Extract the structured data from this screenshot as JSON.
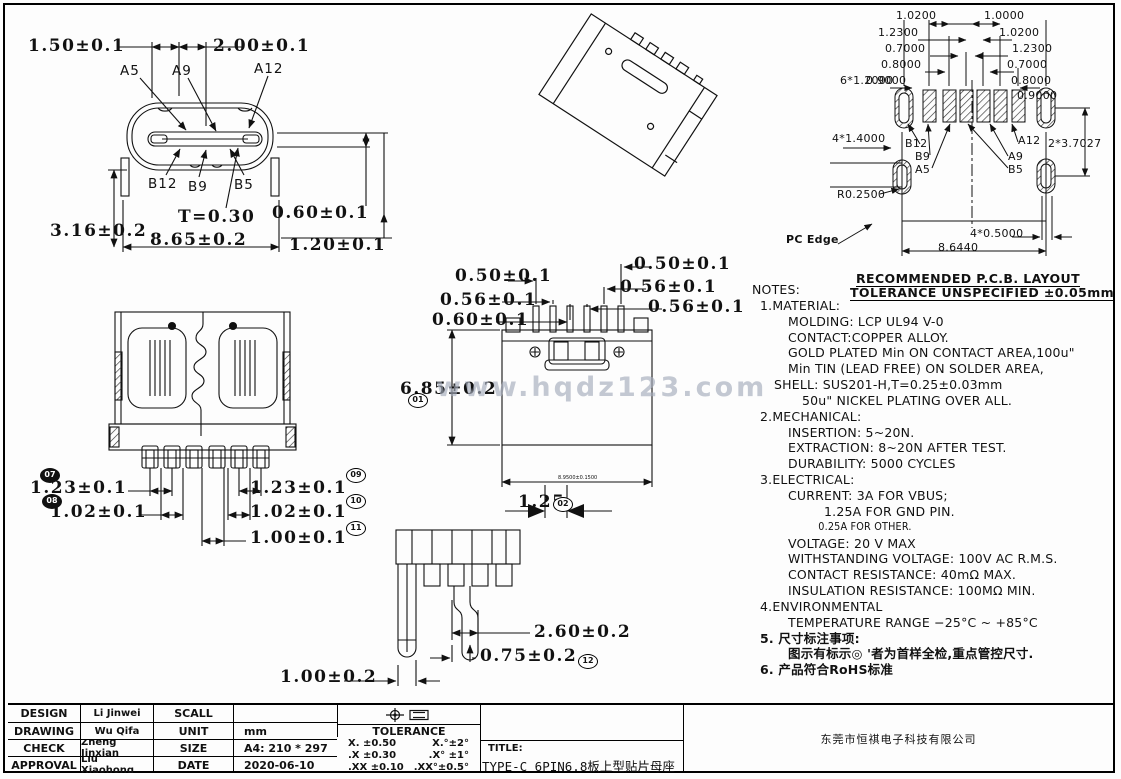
{
  "sheet": {
    "watermark": "www.hqdz123.com"
  },
  "front_view": {
    "dim_width_inner": "1.50±0.1",
    "dim_width_pins": "2.00±0.1",
    "pin_a5": "A5",
    "pin_a9": "A9",
    "pin_a12": "A12",
    "pin_b12": "B12",
    "pin_b9": "B9",
    "pin_b5": "B5",
    "dim_thickness": "T=0.30",
    "dim_0_60": "0.60±0.1",
    "dim_3_16": "3.16±0.2",
    "dim_8_65": "8.65±0.2",
    "dim_1_20": "1.20±0.1"
  },
  "top_view": {
    "dim_1_23_left": "1.23±0.1",
    "dim_1_02_left": "1.02±0.1",
    "dim_1_23_right": "1.23±0.1",
    "dim_1_02_right": "1.02±0.1",
    "dim_1_00": "1.00±0.1",
    "balloon_07": "07",
    "balloon_08": "08",
    "balloon_09": "09",
    "balloon_10": "10",
    "balloon_11": "11"
  },
  "rear_view": {
    "dim_0_50_left": "0.50±0.1",
    "dim_0_50_right": "0.50±0.1",
    "dim_0_56_left": "0.56±0.1",
    "dim_0_56_right": "0.56±0.1",
    "dim_0_56_right2": "0.56±0.1",
    "dim_0_60": "0.60±0.1",
    "dim_6_85": "6.85±0.2",
    "balloon_01": "01",
    "dim_width_small": "8.9500±0.1500",
    "dim_1_25": "1.25",
    "balloon_02": "02"
  },
  "side_view": {
    "dim_2_60": "2.60±0.2",
    "dim_0_75": "0.75±0.2",
    "balloon_12": "12",
    "dim_1_00": "1.00±0.2"
  },
  "pcb_layout": {
    "header_line1": "RECOMMENDED  P.C.B. LAYOUT",
    "header_line2": "TOLERANCE UNSPECIFIED ±0.05mm",
    "dims_left": [
      "1.0200",
      "1.2300",
      "0.7000",
      "0.8000",
      "6*1.2000",
      "0.9000"
    ],
    "dims_right": [
      "1.0000",
      "1.0200",
      "1.2300",
      "0.7000",
      "0.8000",
      "0.9000"
    ],
    "dim_pads": "4*1.4000",
    "dim_radius": "R0.2500",
    "dim_vertical": "2*3.7027",
    "dim_4x0_5": "4*0.5000",
    "dim_total_width": "8.6440",
    "label_pc_edge": "PC Edge",
    "pin_b12": "B12",
    "pin_b9": "B9",
    "pin_a5": "A5",
    "pin_a12": "A12",
    "pin_a9": "A9",
    "pin_b5": "B5"
  },
  "notes": {
    "lines": [
      "NOTES:",
      "1.MATERIAL:",
      "MOLDING: LCP UL94 V-0",
      "CONTACT:COPPER ALLOY.",
      "GOLD PLATED Min ON CONTACT AREA,100u\"",
      "Min TIN (LEAD FREE) ON SOLDER AREA,",
      "SHELL: SUS201-H,T=0.25±0.03mm",
      "50u\" NICKEL PLATING OVER ALL.",
      "2.MECHANICAL:",
      "INSERTION: 5~20N.",
      "EXTRACTION: 8~20N AFTER TEST.",
      "DURABILITY: 5000 CYCLES",
      "3.ELECTRICAL:",
      "CURRENT: 3A FOR VBUS;",
      "1.25A FOR GND PIN.",
      "0.25A FOR OTHER.",
      "VOLTAGE: 20 V MAX",
      "WITHSTANDING VOLTAGE: 100V AC R.M.S.",
      "CONTACT RESISTANCE: 40mΩ MAX.",
      "INSULATION RESISTANCE: 100MΩ MIN.",
      "4.ENVIRONMENTAL",
      "TEMPERATURE RANGE −25°C ~ +85°C",
      "5. 尺寸标注事项:",
      "图示有标示◎ '者为首样全检,重点管控尺寸.",
      "6. 产品符合RoHS标准"
    ]
  },
  "title_block": {
    "staff": [
      {
        "label": "DESIGN",
        "name": "Li Jinwei"
      },
      {
        "label": "DRAWING",
        "name": "Wu Qifa"
      },
      {
        "label": "CHECK",
        "name": "Zheng Jinxian"
      },
      {
        "label": "APPROVAL",
        "name": "Liu Xiaohong"
      }
    ],
    "meta": [
      {
        "label": "SCALL",
        "value": ""
      },
      {
        "label": "UNIT",
        "value": "mm"
      },
      {
        "label": "SIZE",
        "value": "A4: 210 * 297"
      },
      {
        "label": "DATE",
        "value": "2020-06-10"
      }
    ],
    "tolerance_header": "TOLERANCE",
    "tolerance_rows": [
      {
        "left": "X.  ±0.50",
        "right": "X.°±2°"
      },
      {
        "left": ".X  ±0.30",
        "right": ".X° ±1°"
      },
      {
        "left": ".XX ±0.10",
        "right": ".XX°±0.5°"
      }
    ],
    "title_label": "TITLE:",
    "title": "TYPE-C 6PIN6.8板上型贴片母座",
    "company": "东莞市恒祺电子科技有限公司"
  }
}
